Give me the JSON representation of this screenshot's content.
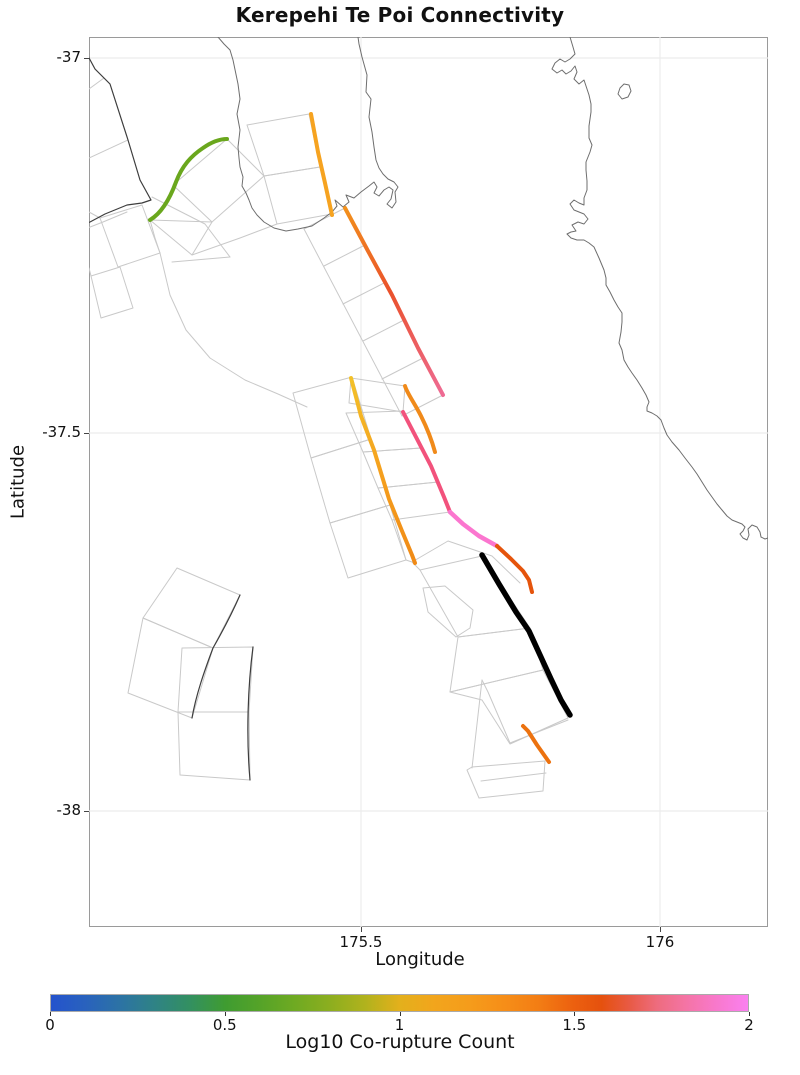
{
  "title": "Kerepehi Te Poi Connectivity",
  "axes": {
    "xlabel": "Longitude",
    "ylabel": "Latitude",
    "x_ticks": [
      {
        "label": "175.5",
        "x": 361
      },
      {
        "label": "176",
        "x": 660
      }
    ],
    "y_ticks": [
      {
        "label": "-37",
        "y": 58
      },
      {
        "label": "-37.5",
        "y": 433
      },
      {
        "label": "-38",
        "y": 811
      }
    ],
    "xlim": [
      175.04,
      176.18
    ],
    "ylim": [
      -38.15,
      -36.97
    ],
    "plot_box": {
      "left": 89,
      "top": 37,
      "width": 679,
      "height": 890
    }
  },
  "colorbar": {
    "label": "Log10 Co-rupture Count",
    "ticks": [
      {
        "label": "0",
        "value": 0
      },
      {
        "label": "0.5",
        "value": 0.5
      },
      {
        "label": "1",
        "value": 1
      },
      {
        "label": "1.5",
        "value": 1.5
      },
      {
        "label": "2",
        "value": 2
      }
    ],
    "value_range": [
      0,
      2
    ],
    "geometry": {
      "x": 50,
      "y": 994,
      "width": 699,
      "height": 18
    },
    "stops": [
      [
        "0",
        "#2453cd"
      ],
      [
        "0.05",
        "#2962bd"
      ],
      [
        "0.1",
        "#2c73a4"
      ],
      [
        "0.15",
        "#2f8384"
      ],
      [
        "0.2",
        "#339060"
      ],
      [
        "0.25",
        "#3f9c31"
      ],
      [
        "0.3",
        "#55a328"
      ],
      [
        "0.35",
        "#6faa22"
      ],
      [
        "0.4",
        "#8cae1f"
      ],
      [
        "0.45",
        "#b0b21d"
      ],
      [
        "0.5",
        "#e3b01c"
      ],
      [
        "0.55",
        "#f2a51c"
      ],
      [
        "0.6",
        "#f59c1b"
      ],
      [
        "0.65",
        "#f68e18"
      ],
      [
        "0.7",
        "#f37d14"
      ],
      [
        "0.75",
        "#ec600f"
      ],
      [
        "0.79",
        "#e5510e"
      ],
      [
        "0.83",
        "#e85a45"
      ],
      [
        "0.87",
        "#ee6c7f"
      ],
      [
        "0.91",
        "#f474a4"
      ],
      [
        "0.95",
        "#f878c8"
      ],
      [
        "1",
        "#fa80f0"
      ]
    ]
  },
  "chart_data": {
    "type": "map",
    "region_hint": "Hauraki Plains / Coromandel area shown by lat-lon axes",
    "gridlines": {
      "x": [
        361,
        660
      ],
      "y": [
        58,
        433,
        811
      ]
    },
    "coastlines": [
      "M 218,37 L 224,44 230,50 233,60 238,84 240,99 237,114 240,130 238,147 239,158 240,167 243,177 242,186 246,193 249,200 252,208 257,215 264,222 274,228 286,231 298,229 312,226 324,218 332,212 337,206 335,200 343,207 349,202 346,195 354,198 361,192 369,186 374,182 377,187 374,193 379,196 384,190 389,187 393,190 391,199 387,204 392,208 396,202 395,192 398,187 394,182 388,179 383,174 379,168 376,160 374,147 372,132 369,117 371,99 366,92 367,75 362,57 359,44 358,37",
      "M 570,37 L 573,47 575,54 570,59 565,62 560,59 555,63 552,69 557,73 562,70 566,74 571,71 575,66 577,72 574,79 579,84 584,80 586,86 589,95 591,104 591,112 589,126 589,138 592,145 590,152 586,162 586,170 587,181 587,190 584,198 584,205 579,203 574,200 570,204 574,210 579,212 584,214 588,219 584,224 578,222 572,225 576,231 571,232 567,234 571,238 577,240 584,240 589,243 594,247 599,258 604,270 606,278 606,285 610,292 614,300 618,307 622,313 622,322 621,332 619,343 622,350 624,360 628,367 632,373 637,380 642,388 646,395 649,402 647,407 647,411 652,413 657,416 661,420 664,428 667,435 672,442 679,450 685,458 692,467 697,474 702,482 707,490 712,497 717,504 722,510 727,516 732,520 737,522 742,524 745,527 743,531 740,534 743,538 747,540 749,535 748,529 752,525 757,527 760,532 761,537 765,539 768,538",
      "M 620,88 L 624,84 629,85 631,91 628,97 622,99 618,94 Z"
    ],
    "fault_sections": [
      "M 89,89 L 104,78",
      "M 89,158 L 128,140",
      "M 85,229 L 103,222 127,212",
      "M 152,197 L 205,224 230,257",
      "M 172,262 L 230,257",
      "M 89,212 L 100,218",
      "M 89,268 L 91,276",
      "M 100,218 L 142,205 160,253 118,267 Z",
      "M 91,276 L 120,267 133,308 101,318 Z",
      "M 150,220 L 155,238 160,253",
      "M 160,253 L 170,295 186,330 210,358 245,380 278,394 307,407",
      "M 173,185 L 227,139 264,176 212,222 Z",
      "M 150,220 L 212,222",
      "M 150,220 L 192,255",
      "M 192,255 L 212,222",
      "M 192,255 L 240,238 277,224",
      "M 247,125 L 309,114 320,167 264,176 Z",
      "M 264,176 L 320,167 332,214 277,224 Z",
      "M 304,229 L 402,416",
      "M 345,208 L 304,229",
      "M 365,245 L 324,266",
      "M 384,283 L 343,304",
      "M 404,320 L 363,341",
      "M 423,358 L 382,379",
      "M 443,395 L 402,416",
      "M 293,393 L 352,377 371,439 311,458 Z",
      "M 311,458 L 371,439 390,505 330,523 Z",
      "M 330,523 L 390,505 406,560 348,578 Z",
      "M 351,378 L 405,386 403,412 349,403 Z",
      "M 346,413 L 404,411 421,448 363,452 Z",
      "M 363,452 L 421,448 438,482 378,488 Z",
      "M 378,488 L 438,482 450,512 392,520 Z",
      "M 392,520 L 406,560",
      "M 406,560 L 412,562 448,541 492,556 520,583",
      "M 412,562 L 420,570",
      "M 420,570 L 482,556 530,628 458,637 Z",
      "M 458,637 L 530,628 543,670 450,692 Z",
      "M 450,692 L 543,670 568,718 510,744 482,700 Z",
      "M 423,588 L 445,586 473,610 470,628 456,637 428,612 Z",
      "M 482,680 L 488,692 510,743 568,720",
      "M 482,680 L 472,768",
      "M 467,770 L 472,767 545,761 543,791 479,798 Z",
      "M 481,781 L 546,773",
      "M 177,568 L 240,595 213,648 143,618 Z",
      "M 143,618 L 213,648 192,718 128,693 Z",
      "M 182,648 L 253,647 249,712 178,712 Z",
      "M 178,712 L 249,712 250,780 180,775 Z"
    ],
    "fault_trace_edges": [
      "M 88,56 L 95,69 103,77 110,84 128,140 140,180 151,200 142,203 127,205 105,214 90,222 85,224",
      "M 240,595 C 230,618 221,634 213,648 C 204,672 196,695 192,718",
      "M 253,647 C 248,685 246,735 250,780"
    ],
    "fault_traces": [
      {
        "id": "trace-green",
        "color": "#6aa71d",
        "width": 4,
        "log10_estimate": 0.6,
        "d": "M 150,220 C 160,214 169,201 176,182 C 182,166 191,156 203,148 C 213,141 221,139 227,139"
      },
      {
        "id": "trace-orange-north",
        "color": "#f6a320",
        "width": 4,
        "log10_estimate": 1.1,
        "d": "M 311,114 L 318,152 325,183 332,215"
      },
      {
        "id": "trace-orange-red-pink",
        "width": 4,
        "log10_estimate": 1.45,
        "gradient": {
          "x1": 345,
          "y1": 208,
          "x2": 443,
          "y2": 395,
          "stops": [
            [
              "0",
              "#f2911c"
            ],
            [
              "0.45",
              "#ea512b"
            ],
            [
              "1",
              "#ee6b94"
            ]
          ]
        },
        "d": "M 345,208 L 368,251 392,295 418,348 443,395"
      },
      {
        "id": "trace-gold",
        "width": 4,
        "log10_estimate": 1.05,
        "gradient": {
          "x1": 351,
          "y1": 378,
          "x2": 415,
          "y2": 563,
          "stops": [
            [
              "0",
              "#f3c129"
            ],
            [
              "0.5",
              "#f5a01e"
            ],
            [
              "1",
              "#f08a16"
            ]
          ]
        },
        "d": "M 351,378 L 361,416 374,450 389,499 402,531 412,555 415,563"
      },
      {
        "id": "trace-orange-arc",
        "color": "#f08a1a",
        "width": 4,
        "log10_estimate": 1.2,
        "d": "M 405,386 C 407,393 415,404 421,416 C 427,428 432,441 435,452"
      },
      {
        "id": "trace-rose",
        "color": "#f2527c",
        "width": 4,
        "log10_estimate": 1.65,
        "d": "M 403,412 L 417,439 431,466 444,497 450,512"
      },
      {
        "id": "trace-magenta",
        "color": "#fb76cf",
        "width": 4.5,
        "log10_estimate": 1.9,
        "d": "M 450,512 L 463,524 479,536 497,546"
      },
      {
        "id": "trace-vermilion",
        "color": "#e5540c",
        "width": 4,
        "log10_estimate": 1.45,
        "d": "M 497,546 L 511,559 523,571 529,580 532,592"
      },
      {
        "id": "trace-black-highlight",
        "color": "#000000",
        "width": 5.5,
        "log10_estimate": null,
        "d": "M 482,555 L 499,584 516,612 529,631 540,655 551,679 561,700 570,715"
      },
      {
        "id": "trace-orange-south",
        "color": "#ec720f",
        "width": 4,
        "log10_estimate": 1.3,
        "d": "M 523,726 L 528,731 537,745 549,762"
      }
    ]
  }
}
